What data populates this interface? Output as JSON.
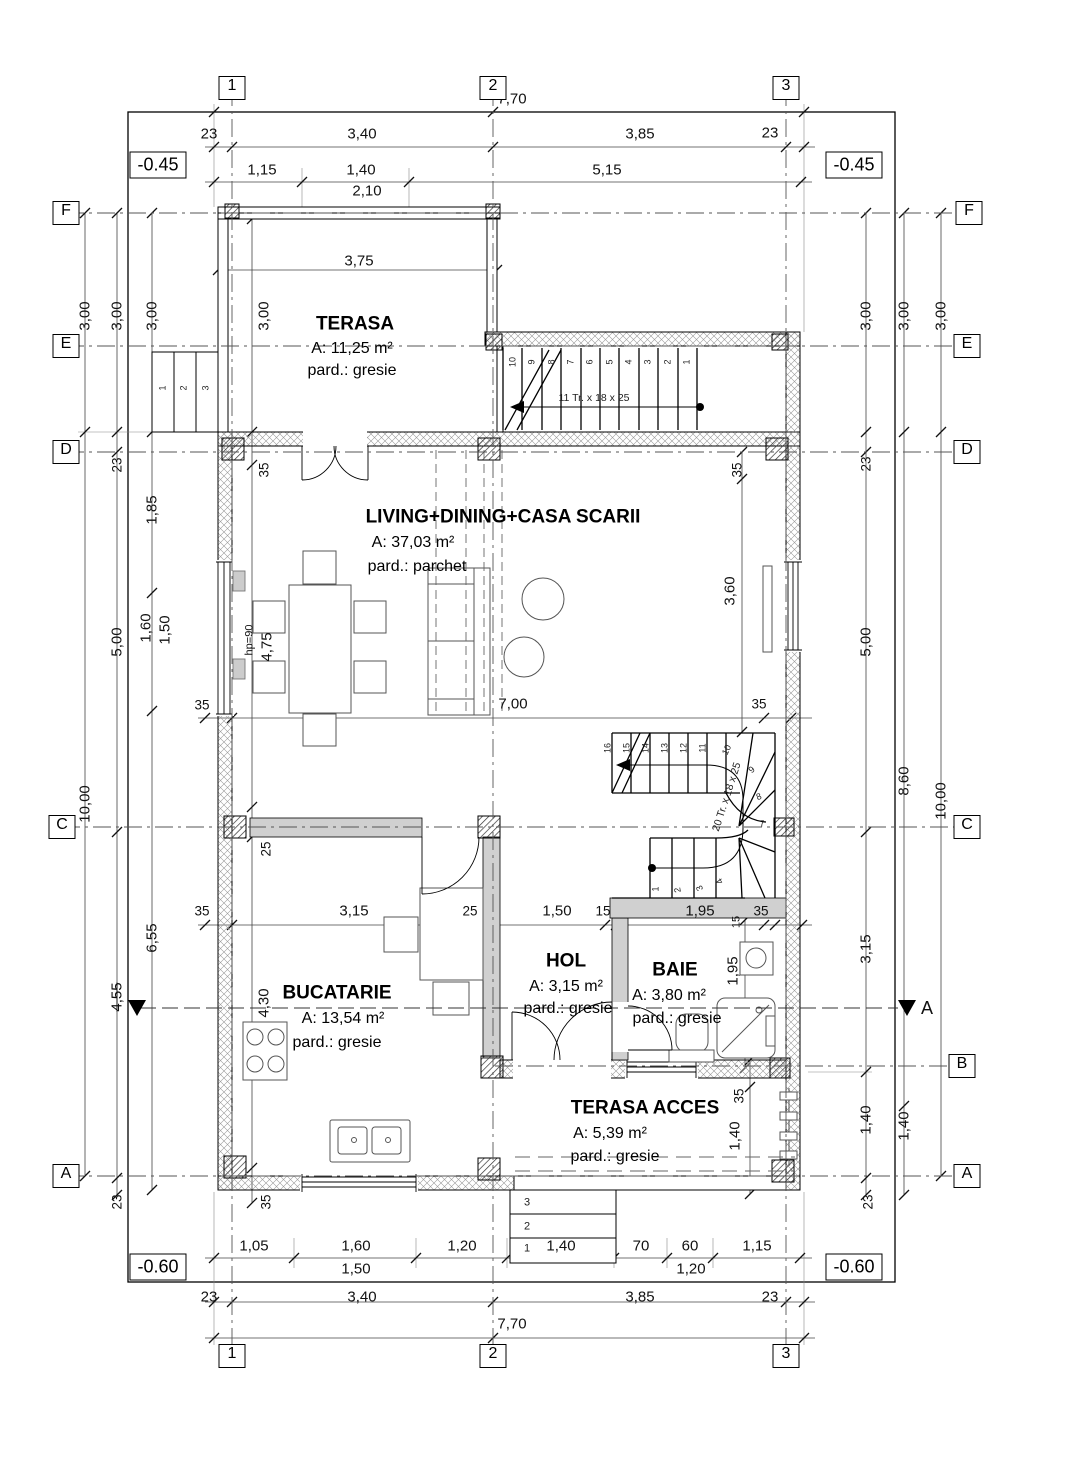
{
  "drawing": {
    "grid": {
      "cols": [
        "1",
        "2",
        "3"
      ],
      "rows_left": [
        "F",
        "E",
        "D",
        "C",
        "A"
      ],
      "rows_right": [
        "F",
        "E",
        "D",
        "C",
        "B",
        "A"
      ]
    },
    "elevations": {
      "top_left": "-0.45",
      "top_right": "-0.45",
      "bottom_left": "-0.60",
      "bottom_right": "-0.60"
    },
    "section_label": "A",
    "rooms": [
      {
        "name": "TERASA",
        "area": "A: 11,25 m²",
        "floor": "pard.: gresie"
      },
      {
        "name": "LIVING+DINING+CASA SCARII",
        "area": "A: 37,03 m²",
        "floor": "pard.: parchet"
      },
      {
        "name": "BUCATARIE",
        "area": "A: 13,54 m²",
        "floor": "pard.: gresie"
      },
      {
        "name": "HOL",
        "area": "A: 3,15 m²",
        "floor": "pard.: gresie"
      },
      {
        "name": "BAIE",
        "area": "A: 3,80 m²",
        "floor": "pard.: gresie"
      },
      {
        "name": "TERASA ACCES",
        "area": "A: 5,39 m²",
        "floor": "pard.: gresie"
      }
    ],
    "stairs": {
      "top_flight": {
        "note": "11 Tr. x 18 x 25",
        "treads": [
          "1",
          "2",
          "3",
          "4",
          "5",
          "6",
          "7",
          "8",
          "9",
          "10"
        ]
      },
      "main_flight": {
        "note": "20 Tr. x 18 x 25",
        "upper": [
          "16",
          "15",
          "14",
          "13",
          "12",
          "11"
        ],
        "winders": [
          "10",
          "9",
          "8",
          "7"
        ],
        "lower": [
          "1",
          "2",
          "3",
          "4"
        ]
      },
      "exterior_left": [
        "1",
        "2",
        "3"
      ],
      "exterior_bottom": [
        "3",
        "2",
        "1"
      ]
    },
    "dims": {
      "top": {
        "overall": "7,70",
        "chain1": [
          "23",
          "3,40",
          "3,85",
          "23"
        ],
        "chain2": [
          "1,15",
          "1,40",
          "5,15"
        ],
        "sub": "2,10",
        "terrace_width": "3,75"
      },
      "bottom": {
        "chain1": [
          "1,05",
          "1,60",
          "1,20",
          "1,40",
          "70",
          "60",
          "1,15"
        ],
        "sub_1": "1,50",
        "sub_2": "1,20",
        "chain2": [
          "23",
          "3,40",
          "3,85",
          "23"
        ],
        "overall": "7,70"
      },
      "left": {
        "outer": [
          "3,00",
          "10,00"
        ],
        "mid": [
          "3,00",
          "23",
          "5,00",
          "4,55",
          "23"
        ],
        "inner": [
          "3,00",
          "1,85",
          "1,60",
          "1,50",
          "6,55"
        ],
        "wall": [
          "3,00",
          "35",
          "hp=90",
          "4,75",
          "25",
          "4,30",
          "35"
        ]
      },
      "right": {
        "inner": [
          "3,00",
          "23",
          "5,00",
          "3,15",
          "1,40",
          "23"
        ],
        "mid": [
          "3,00",
          "8,60",
          "1,40"
        ],
        "outer": [
          "3,00",
          "10,00"
        ],
        "wall": [
          "35",
          "3,60",
          "1,95",
          "35",
          "1,40"
        ]
      },
      "mid": {
        "row": [
          "35",
          "7,00",
          "35"
        ]
      },
      "interior_row": [
        "35",
        "3,15",
        "25",
        "1,50",
        "15",
        "1,95",
        "15",
        "35"
      ]
    }
  }
}
